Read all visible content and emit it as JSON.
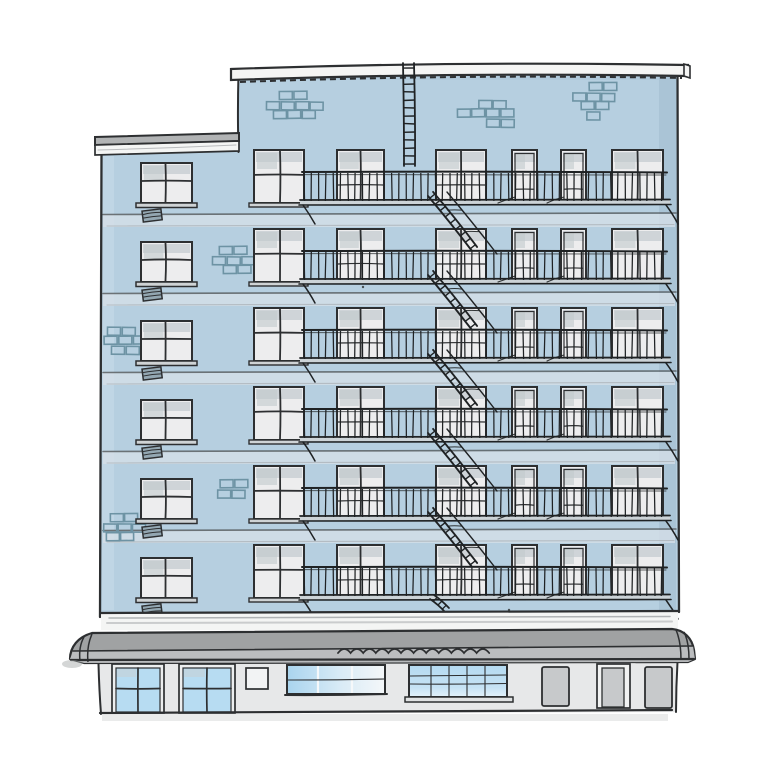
{
  "meta": {
    "title": "Hand-drawn illustration of a light blue apartment building facade with fire escapes, a gray awning and a storefront at street level",
    "background": "#ffffff",
    "canvas": {
      "width": 768,
      "height": 768
    }
  },
  "palette": {
    "facade": "#b6cfe0",
    "facade_shadow": "#a8c2d4",
    "facade_light": "#c9dce9",
    "floor_band": "#d4dfe7",
    "ink": "#2d2f31",
    "ink_soft": "#53575a",
    "metal": "#1f2224",
    "glass": "#ededee",
    "glass_shade": "#c9cfd3",
    "glass_blob": "#c2c9cd",
    "brick": "#6d93a4",
    "coping": "#f5f5f4",
    "cornice_gray": "#b1b3b4",
    "cornice_white": "#f4f5f4",
    "white_band_line": "#9fa3a5",
    "awning_dark": "#a0a2a3",
    "awning_light": "#bdbfc1",
    "store_wall": "#e7e8e9",
    "store_glass": "#b7dcf2",
    "door_gray": "#c7c9cb",
    "door_frame_white": "#f1f2f2",
    "ground_shadow": "#d9dadb",
    "sill_gray": "#cfd3d5",
    "platform_gray": "#ccd3d7",
    "vent": "#93a7b2"
  },
  "building": {
    "main_wall": {
      "left": 238,
      "top": 70,
      "right": 678,
      "bottom": 612
    },
    "left_wing": {
      "left": 101,
      "top": 152,
      "right": 238
    },
    "roof": {
      "coping_left": 231,
      "coping_right": 688,
      "top_left_y": 69,
      "top_mid_y": 61,
      "top_right_y": 65,
      "thickness": 11,
      "dash_y_offset": 6,
      "dash_pattern": "6 4",
      "end_cap": {
        "x": 684,
        "w": 6
      }
    },
    "left_cornice": {
      "x1": 95,
      "x2": 239,
      "y_left": 137,
      "y_right": 133,
      "gray_h": 8,
      "white_h": 10
    },
    "floors": {
      "count": 6,
      "first_window_top": 150,
      "spacing": 79,
      "window_height": 53
    },
    "window_columns": [
      {
        "x": 254,
        "w": 50,
        "style": "cross",
        "sill": true
      },
      {
        "x": 337,
        "w": 47,
        "style": "two_pane",
        "sill": false
      },
      {
        "x": 436,
        "w": 50,
        "style": "two_pane",
        "sill": false
      },
      {
        "x": 512,
        "w": 25,
        "style": "door",
        "sill": false
      },
      {
        "x": 561,
        "w": 25,
        "style": "door",
        "sill": false
      },
      {
        "x": 612,
        "w": 51,
        "style": "two_pane_tall",
        "sill": false
      }
    ],
    "left_window": {
      "x": 141,
      "w": 51,
      "h": 40,
      "top_offset": 13,
      "vent_w": 19,
      "vent_h": 11
    },
    "brick_patches": [
      {
        "x": 267,
        "y": 92,
        "rows": [
          {
            "o": 12,
            "c": 2
          },
          {
            "o": 0,
            "c": 4
          },
          {
            "o": 6,
            "c": 3
          }
        ]
      },
      {
        "x": 457,
        "y": 100,
        "rows": [
          {
            "o": 22,
            "c": 2
          },
          {
            "o": 0,
            "c": 4
          },
          {
            "o": 30,
            "c": 2
          }
        ]
      },
      {
        "x": 573,
        "y": 83,
        "rows": [
          {
            "o": 16,
            "c": 2
          },
          {
            "o": 0,
            "c": 3
          },
          {
            "o": 8,
            "c": 2
          },
          {
            "o": 14,
            "c": 1
          }
        ]
      },
      {
        "x": 213,
        "y": 247,
        "rows": [
          {
            "o": 6,
            "c": 2
          },
          {
            "o": 0,
            "c": 3
          },
          {
            "o": 10,
            "c": 2
          }
        ]
      },
      {
        "x": 104,
        "y": 327,
        "rows": [
          {
            "o": 4,
            "c": 2
          },
          {
            "o": 0,
            "c": 3
          },
          {
            "o": 8,
            "c": 2
          }
        ]
      },
      {
        "x": 218,
        "y": 480,
        "rows": [
          {
            "o": 2,
            "c": 2
          },
          {
            "o": 0,
            "c": 2
          }
        ]
      },
      {
        "x": 104,
        "y": 514,
        "rows": [
          {
            "o": 6,
            "c": 2
          },
          {
            "o": 0,
            "c": 3
          },
          {
            "o": 2,
            "c": 2
          }
        ]
      }
    ],
    "brick_size": {
      "w": 13,
      "h": 8,
      "gap": 1.5
    },
    "fire_escape": {
      "balcony_left": 300,
      "balcony_right": 668,
      "rail_offset": 22,
      "platform_offset": 50,
      "baluster_spacing": 7.3,
      "stair": {
        "top_x": 428,
        "top_dy": 46,
        "bot_x": 472,
        "bot_dy": 101,
        "width": 6.5,
        "rungs": 8
      },
      "roof_ladder": {
        "x": 403,
        "width": 11,
        "top": 63,
        "bottom": 166,
        "rung_spacing": 8
      },
      "drop_stub": {
        "x": 430,
        "y": 599
      }
    },
    "white_band": {
      "top": 612,
      "bottom": 630
    }
  },
  "awning": {
    "left": 70,
    "right": 696,
    "top_left_y": 633,
    "top_right_y": 629,
    "bottom_left_y": 662,
    "bottom_right_y": 659,
    "divider_left_y": 649,
    "divider_right_y": 646,
    "squiggle": {
      "x1": 338,
      "y": 653,
      "waves": 12,
      "wave_w": 12.6,
      "wave_h": 8
    }
  },
  "storefront": {
    "wall": {
      "left": 98,
      "right": 678,
      "top": 661,
      "bottom": 712
    },
    "items": [
      {
        "type": "paned_window",
        "x": 114,
        "y": 665,
        "w": 48,
        "h": 47
      },
      {
        "type": "paned_window",
        "x": 181,
        "y": 665,
        "w": 52,
        "h": 47
      },
      {
        "type": "small_window",
        "x": 246,
        "y": 668,
        "w": 22,
        "h": 21
      },
      {
        "type": "wide_window_a",
        "x": 287,
        "y": 665,
        "w": 98,
        "h": 29
      },
      {
        "type": "wide_window_b",
        "x": 409,
        "y": 665,
        "w": 98,
        "h": 32
      },
      {
        "type": "door",
        "x": 542,
        "y": 667,
        "w": 27,
        "h": 39
      },
      {
        "type": "framed_door",
        "x": 597,
        "y": 664,
        "w": 33,
        "h": 44
      },
      {
        "type": "door",
        "x": 645,
        "y": 667,
        "w": 27,
        "h": 41
      }
    ]
  },
  "specks": [
    [
      363,
      287
    ],
    [
      509,
      610
    ]
  ]
}
